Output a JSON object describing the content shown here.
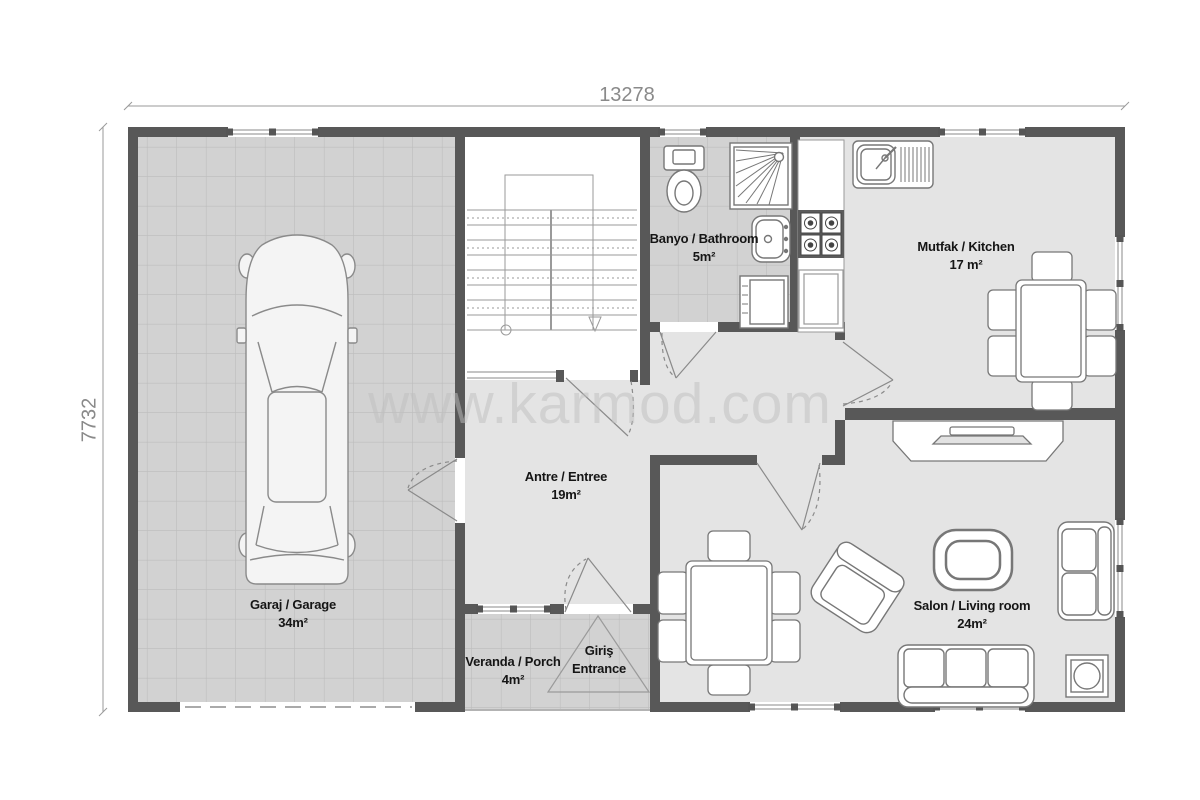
{
  "plan": {
    "watermark": "www.karmod.com",
    "dimensions": {
      "width_label": "13278",
      "height_label": "7732"
    },
    "rooms": {
      "garage": {
        "name": "Garaj / Garage",
        "area": "34m²"
      },
      "bathroom": {
        "name": "Banyo / Bathroom",
        "area": "5m²"
      },
      "kitchen": {
        "name": "Mutfak / Kitchen",
        "area": "17 m²"
      },
      "hall": {
        "name": "Antre / Entree",
        "area": "19m²"
      },
      "veranda": {
        "name": "Veranda / Porch",
        "area": "4m²"
      },
      "salon": {
        "name": "Salon / Living room",
        "area": "24m²"
      },
      "entrance": {
        "name_tr": "Giriş",
        "name_en": "Entrance"
      }
    },
    "colors": {
      "wall": "#585858",
      "tile_floor": "#d2d2d2",
      "tile_grid": "#bdbdbd",
      "room_floor": "#e4e4e4",
      "outline": "#8a8a8a",
      "dimension_text": "#8a8a8a",
      "watermark_text": "#bfbfbf"
    },
    "fixture_icons": [
      "car-icon",
      "staircase-icon",
      "toilet-icon",
      "shower-icon",
      "washbasin-icon",
      "washing-machine-icon",
      "kitchen-sink-icon",
      "stove-icon",
      "refrigerator-icon",
      "kitchen-table-icon",
      "dining-table-icon",
      "tv-unit-icon",
      "coffee-table-icon",
      "armchair-icon",
      "loveseat-icon",
      "sofa-icon",
      "heater-icon",
      "entrance-arrow-icon"
    ]
  }
}
